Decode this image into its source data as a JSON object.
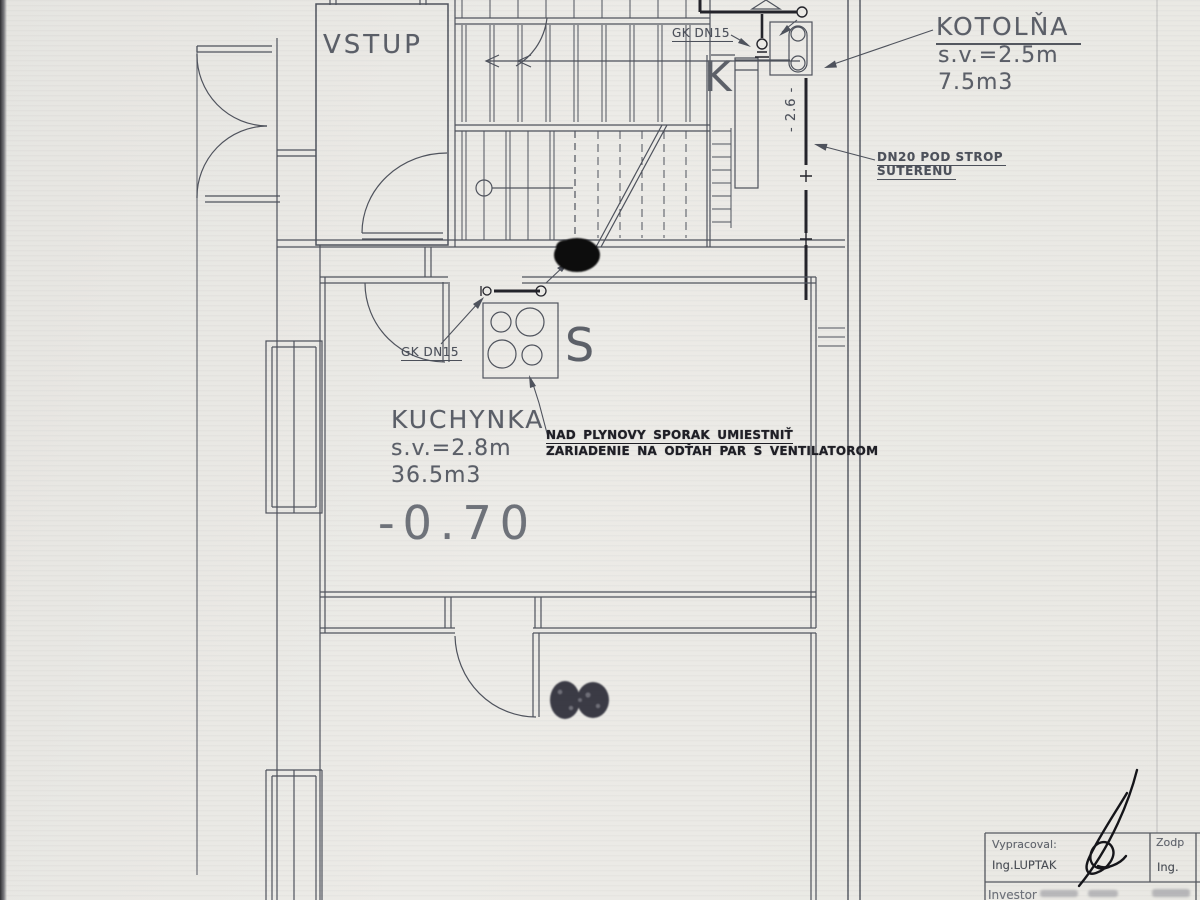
{
  "colors": {
    "paper": "#e9e8e4",
    "ink": "#4f535d",
    "ink_bold": "#24242b",
    "text_gray": "#5a5e66",
    "text_bold": "#1f1f26"
  },
  "plan": {
    "rooms": {
      "vstup": {
        "label": "VSTUP"
      },
      "kotolna": {
        "label": "KOTOLŇA",
        "height": "s.v.=2.5m",
        "volume": "7.5m3",
        "letter": "K"
      },
      "kuchynka": {
        "label": "KUCHYNKA",
        "height": "s.v.=2.8m",
        "volume": "36.5m3",
        "level": "-0.70",
        "stove_letter": "S"
      }
    },
    "pipe_labels": {
      "gk_dn15_top": "GK DN15",
      "gk_dn15_kitchen": "GK DN15",
      "dn20_line1": "DN20 POD STROP",
      "dn20_line2": "SUTERENU",
      "riser_dim": "- 2.6 -"
    },
    "annotation": {
      "line1": "NAD PLYNOVY SPORAK UMIESTNIŤ",
      "line2": "ZARIADENIE NA ODŤAH PAR S VENTILATOROM"
    }
  },
  "titleblock": {
    "author_label": "Vypracoval:",
    "author_name": "Ing.LUPTAK",
    "responsible_label": "Zodp",
    "responsible_name": "Ing.",
    "investor_label": "Investor"
  }
}
